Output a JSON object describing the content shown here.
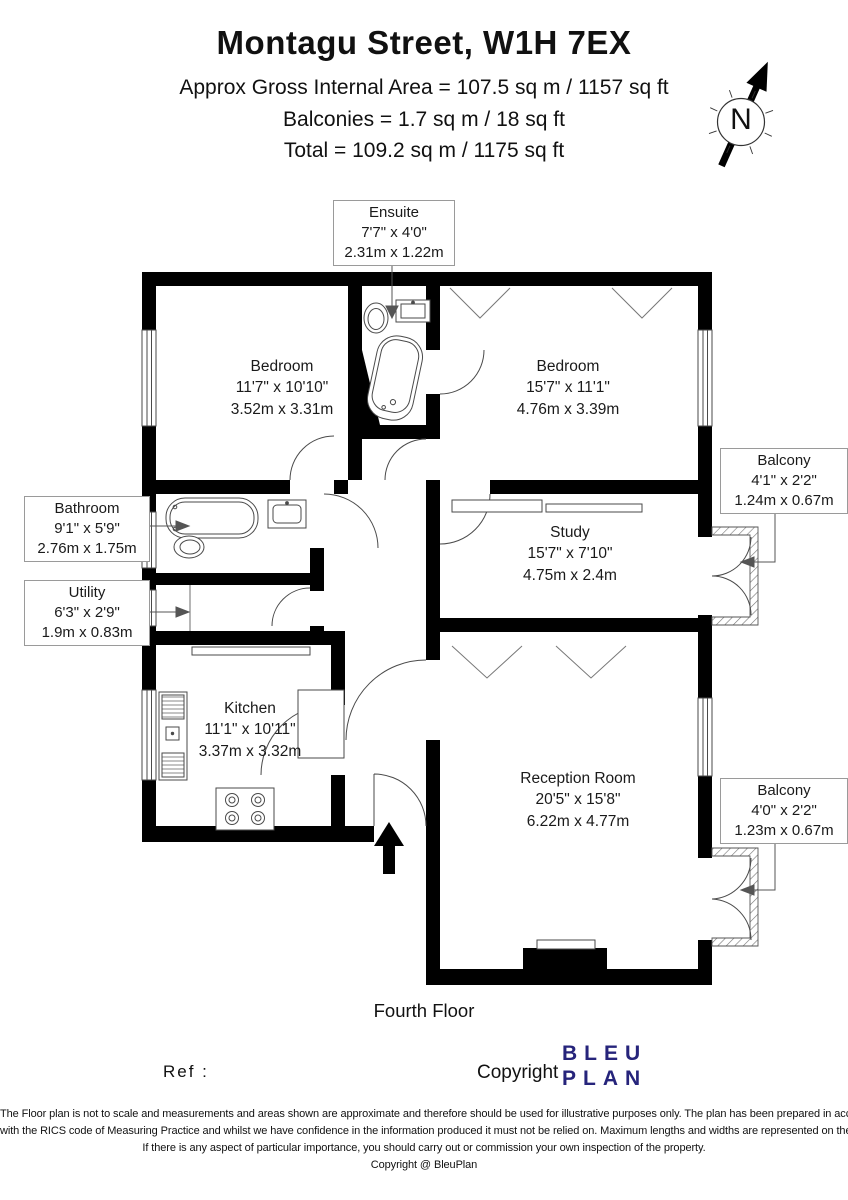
{
  "header": {
    "title": "Montagu Street, W1H 7EX",
    "area_line1": "Approx Gross Internal Area = 107.5 sq m / 1157 sq ft",
    "area_line2": "Balconies = 1.7 sq m / 18 sq ft",
    "area_line3": "Total = 109.2 sq m / 1175 sq ft"
  },
  "compass": {
    "north": "N"
  },
  "rooms": {
    "bedroom1": {
      "name": "Bedroom",
      "imperial": "11'7\" x 10'10\"",
      "metric": "3.52m x 3.31m"
    },
    "bedroom2": {
      "name": "Bedroom",
      "imperial": "15'7\" x 11'1\"",
      "metric": "4.76m x 3.39m"
    },
    "study": {
      "name": "Study",
      "imperial": "15'7\" x 7'10\"",
      "metric": "4.75m x 2.4m"
    },
    "kitchen": {
      "name": "Kitchen",
      "imperial": "11'1\" x 10'11\"",
      "metric": "3.37m x 3.32m"
    },
    "reception": {
      "name": "Reception Room",
      "imperial": "20'5\" x 15'8\"",
      "metric": "6.22m x 4.77m"
    }
  },
  "callouts": {
    "ensuite": {
      "name": "Ensuite",
      "imperial": "7'7\" x 4'0\"",
      "metric": "2.31m x 1.22m"
    },
    "bathroom": {
      "name": "Bathroom",
      "imperial": "9'1\" x 5'9\"",
      "metric": "2.76m x 1.75m"
    },
    "utility": {
      "name": "Utility",
      "imperial": "6'3\" x 2'9\"",
      "metric": "1.9m x 0.83m"
    },
    "balcony1": {
      "name": "Balcony",
      "imperial": "4'1\" x 2'2\"",
      "metric": "1.24m x 0.67m"
    },
    "balcony2": {
      "name": "Balcony",
      "imperial": "4'0\" x 2'2\"",
      "metric": "1.23m x 0.67m"
    }
  },
  "footer": {
    "floor_name": "Fourth Floor",
    "ref_label": "Ref :",
    "copyright_label": "Copyright",
    "logo_line1": "BLEU",
    "logo_line2": "PLAN",
    "disclaimer_line1": "The Floor plan is not to scale and measurements and areas shown are approximate and therefore should be used for illustrative purposes only. The plan has been prepared in accordance",
    "disclaimer_line2": "with the RICS code of Measuring Practice and whilst we have confidence in the information produced it must not be relied on. Maximum lengths and widths are represented on the floor plan.",
    "disclaimer_line3": "If there is any aspect of particular importance, you should carry out or commission your own inspection of the property.",
    "disclaimer_line4": "Copyright @ BleuPlan"
  },
  "colors": {
    "wall": "#000000",
    "logo": "#26247b",
    "thin_line": "#4a4a4a"
  }
}
